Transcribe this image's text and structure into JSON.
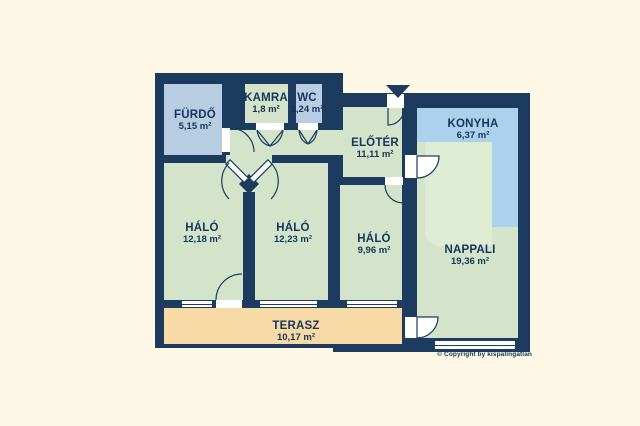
{
  "colors": {
    "background": "#fdf8e6",
    "wall": "#1d3b5e",
    "green": "#d3e4cb",
    "green-light": "#dfecd4",
    "blue": "#b7cde2",
    "kitchen": "#abd1ec",
    "tan": "#f7daa6",
    "white": "#ffffff",
    "label": "#16355a"
  },
  "plan": {
    "rooms": {
      "furdo": {
        "name": "FÜRDŐ",
        "area": "5,15 m²"
      },
      "kamra": {
        "name": "KAMRA",
        "area": "1,8 m²"
      },
      "wc": {
        "name": "WC",
        "area": "1,24 m²"
      },
      "eloter": {
        "name": "ELŐTÉR",
        "area": "11,11 m²"
      },
      "konyha": {
        "name": "KONYHA",
        "area": "6,37 m²"
      },
      "halo1": {
        "name": "HÁLÓ",
        "area": "12,18 m²"
      },
      "halo2": {
        "name": "HÁLÓ",
        "area": "12,23 m²"
      },
      "halo3": {
        "name": "HÁLÓ",
        "area": "9,96 m²"
      },
      "nappali": {
        "name": "NAPPALI",
        "area": "19,36 m²"
      },
      "terasz": {
        "name": "TERASZ",
        "area": "10,17 m²"
      }
    },
    "icons": {
      "entrance": "entrance-arrow"
    },
    "copyright": "© Copyright by kispalingatlan"
  }
}
